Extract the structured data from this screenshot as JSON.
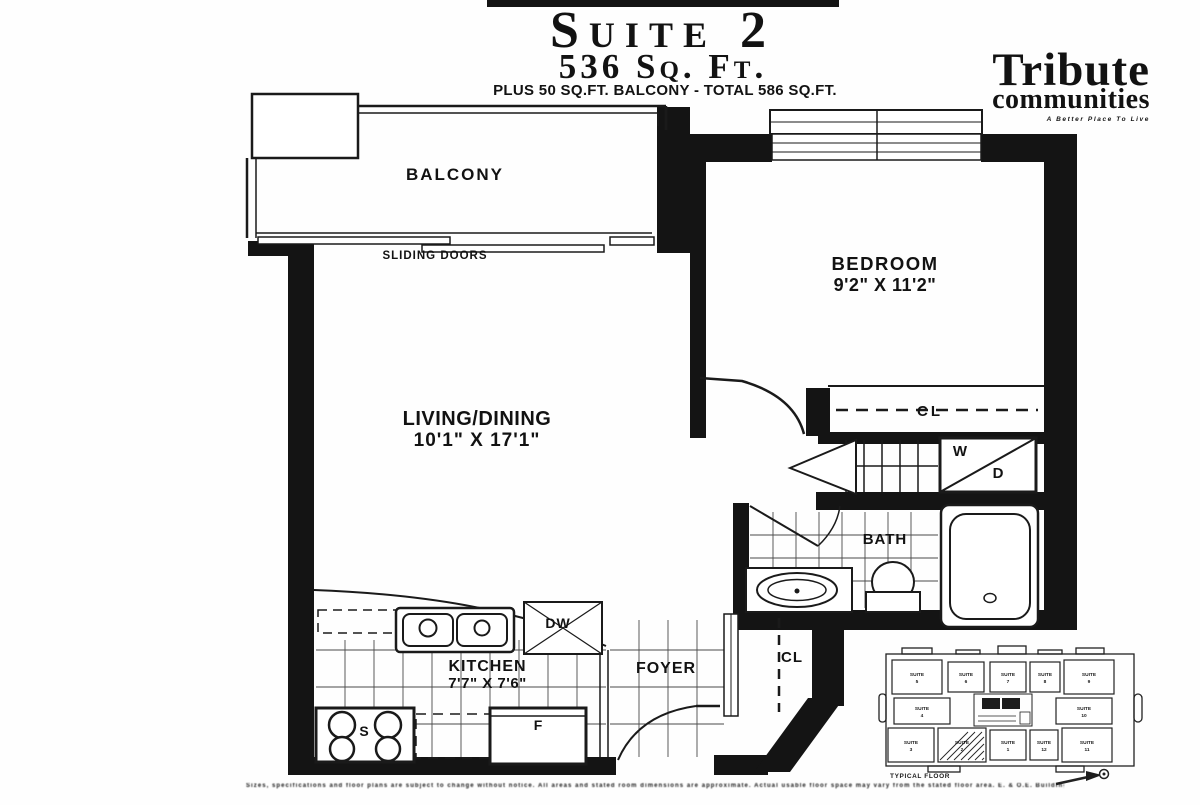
{
  "header": {
    "suite_title": "Suite 2",
    "area": "536 Sq. Ft.",
    "balcony_note": "PLUS 50 SQ.FT. BALCONY - TOTAL 586 SQ.FT."
  },
  "logo": {
    "brand": "Tribute",
    "brand_sub": "communities",
    "tagline": "A Better Place To Live"
  },
  "floorplan": {
    "labels": {
      "balcony": "BALCONY",
      "sliding_doors": "SLIDING DOORS",
      "bedroom_name": "BEDROOM",
      "bedroom_dims": "9'2\" X 11'2\"",
      "living_name": "LIVING/DINING",
      "living_dims": "10'1\" X 17'1\"",
      "kitchen_name": "KITCHEN",
      "kitchen_dims": "7'7\" X 7'6\"",
      "foyer": "FOYER",
      "bath": "BATH",
      "closet_bedroom": "CL",
      "closet_foyer": "CL",
      "washer": "W",
      "dryer": "D",
      "dishwasher": "DW",
      "fridge": "F",
      "stove": "S"
    }
  },
  "keyplan": {
    "caption": "TYPICAL FLOOR",
    "highlighted_suite": "SUITE 2",
    "suites": [
      "SUITE 5",
      "SUITE 6",
      "SUITE 7",
      "SUITE 8",
      "SUITE 9",
      "SUITE 4",
      "SUITE 10",
      "SUITE 3",
      "SUITE 2",
      "SUITE 1",
      "SUITE 12",
      "SUITE 11"
    ]
  },
  "disclaimer": "Sizes, specifications and floor plans are subject to change without notice. All areas and stated room dimensions are approximate. Actual usable floor space may vary from the stated floor area. E. & O.E. Building 2"
}
